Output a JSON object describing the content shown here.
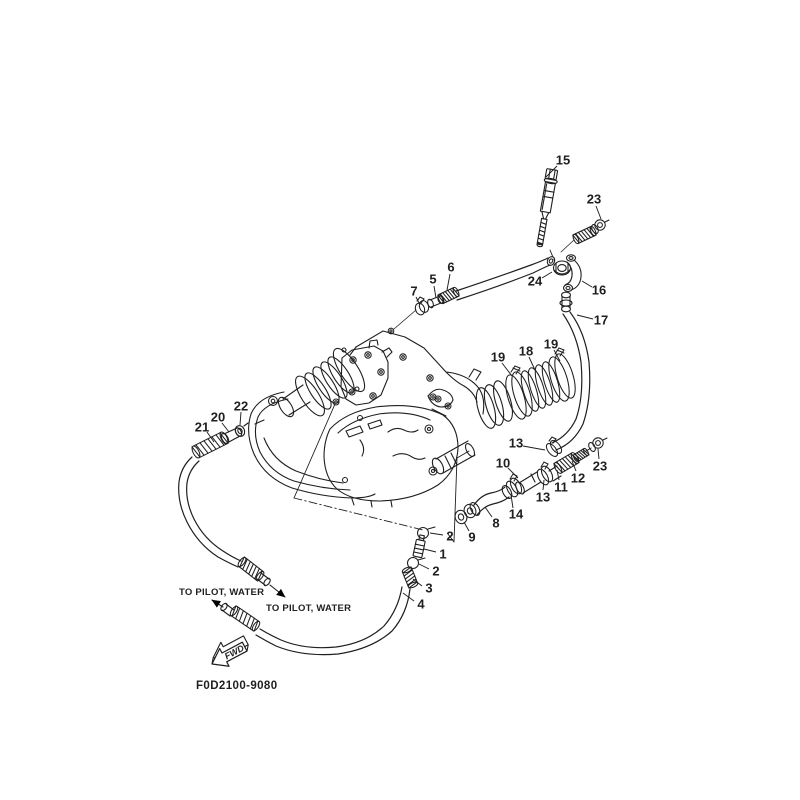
{
  "diagram": {
    "part_code": "F0D2100-9080",
    "fwd_label": "FWD",
    "pilot_labels": [
      {
        "text": "TO PILOT, WATER",
        "x": 179,
        "y": 595
      },
      {
        "text": "TO PILOT, WATER",
        "x": 266,
        "y": 611
      }
    ],
    "callouts": [
      {
        "n": "15",
        "x": 563,
        "y": 160,
        "x1": 557,
        "y1": 166,
        "x2": 546,
        "y2": 177
      },
      {
        "n": "23",
        "x": 594,
        "y": 199,
        "x1": 596,
        "y1": 206,
        "x2": 601,
        "y2": 219
      },
      {
        "n": "24",
        "x": 535,
        "y": 281,
        "x1": 542,
        "y1": 278,
        "x2": 552,
        "y2": 272
      },
      {
        "n": "16",
        "x": 599,
        "y": 290,
        "x1": 592,
        "y1": 287,
        "x2": 582,
        "y2": 281
      },
      {
        "n": "17",
        "x": 601,
        "y": 320,
        "x1": 593,
        "y1": 319,
        "x2": 577,
        "y2": 315
      },
      {
        "n": "6",
        "x": 451,
        "y": 267,
        "x1": 450,
        "y1": 274,
        "x2": 447,
        "y2": 290
      },
      {
        "n": "5",
        "x": 433,
        "y": 279,
        "x1": 434,
        "y1": 286,
        "x2": 436,
        "y2": 298
      },
      {
        "n": "7",
        "x": 414,
        "y": 291,
        "x1": 416,
        "y1": 297,
        "x2": 420,
        "y2": 305
      },
      {
        "n": "19",
        "x": 498,
        "y": 357,
        "x1": 502,
        "y1": 363,
        "x2": 512,
        "y2": 376
      },
      {
        "n": "18",
        "x": 526,
        "y": 351,
        "x1": 529,
        "y1": 357,
        "x2": 535,
        "y2": 370
      },
      {
        "n": "19",
        "x": 551,
        "y": 344,
        "x1": 554,
        "y1": 350,
        "x2": 560,
        "y2": 361
      },
      {
        "n": "22",
        "x": 241,
        "y": 406,
        "x1": 241,
        "y1": 412,
        "x2": 240,
        "y2": 425
      },
      {
        "n": "20",
        "x": 218,
        "y": 417,
        "x1": 222,
        "y1": 423,
        "x2": 229,
        "y2": 432
      },
      {
        "n": "21",
        "x": 202,
        "y": 427,
        "x1": 207,
        "y1": 432,
        "x2": 214,
        "y2": 442
      },
      {
        "n": "13",
        "x": 516,
        "y": 443,
        "x1": 523,
        "y1": 446,
        "x2": 545,
        "y2": 450
      },
      {
        "n": "10",
        "x": 503,
        "y": 463,
        "x1": 508,
        "y1": 468,
        "x2": 518,
        "y2": 478
      },
      {
        "n": "12",
        "x": 578,
        "y": 478,
        "x1": 576,
        "y1": 471,
        "x2": 572,
        "y2": 461
      },
      {
        "n": "11",
        "x": 561,
        "y": 487,
        "x1": 559,
        "y1": 480,
        "x2": 557,
        "y2": 470
      },
      {
        "n": "23",
        "x": 600,
        "y": 466,
        "x1": 599,
        "y1": 459,
        "x2": 598,
        "y2": 449
      },
      {
        "n": "13",
        "x": 543,
        "y": 497,
        "x1": 543,
        "y1": 490,
        "x2": 544,
        "y2": 480
      },
      {
        "n": "14",
        "x": 516,
        "y": 514,
        "x1": 513,
        "y1": 508,
        "x2": 511,
        "y2": 495
      },
      {
        "n": "8",
        "x": 496,
        "y": 523,
        "x1": 492,
        "y1": 517,
        "x2": 485,
        "y2": 507
      },
      {
        "n": "9",
        "x": 472,
        "y": 537,
        "x1": 469,
        "y1": 531,
        "x2": 464,
        "y2": 522
      },
      {
        "n": "2",
        "x": 450,
        "y": 536,
        "x1": 443,
        "y1": 535,
        "x2": 430,
        "y2": 533
      },
      {
        "n": "1",
        "x": 443,
        "y": 554,
        "x1": 436,
        "y1": 552,
        "x2": 424,
        "y2": 549
      },
      {
        "n": "2",
        "x": 436,
        "y": 571,
        "x1": 429,
        "y1": 569,
        "x2": 419,
        "y2": 564
      },
      {
        "n": "3",
        "x": 429,
        "y": 588,
        "x1": 422,
        "y1": 586,
        "x2": 413,
        "y2": 579
      },
      {
        "n": "4",
        "x": 421,
        "y": 604,
        "x1": 414,
        "y1": 601,
        "x2": 403,
        "y2": 593
      }
    ]
  },
  "colors": {
    "ink": "#1f1f1f",
    "paper": "#ffffff"
  }
}
